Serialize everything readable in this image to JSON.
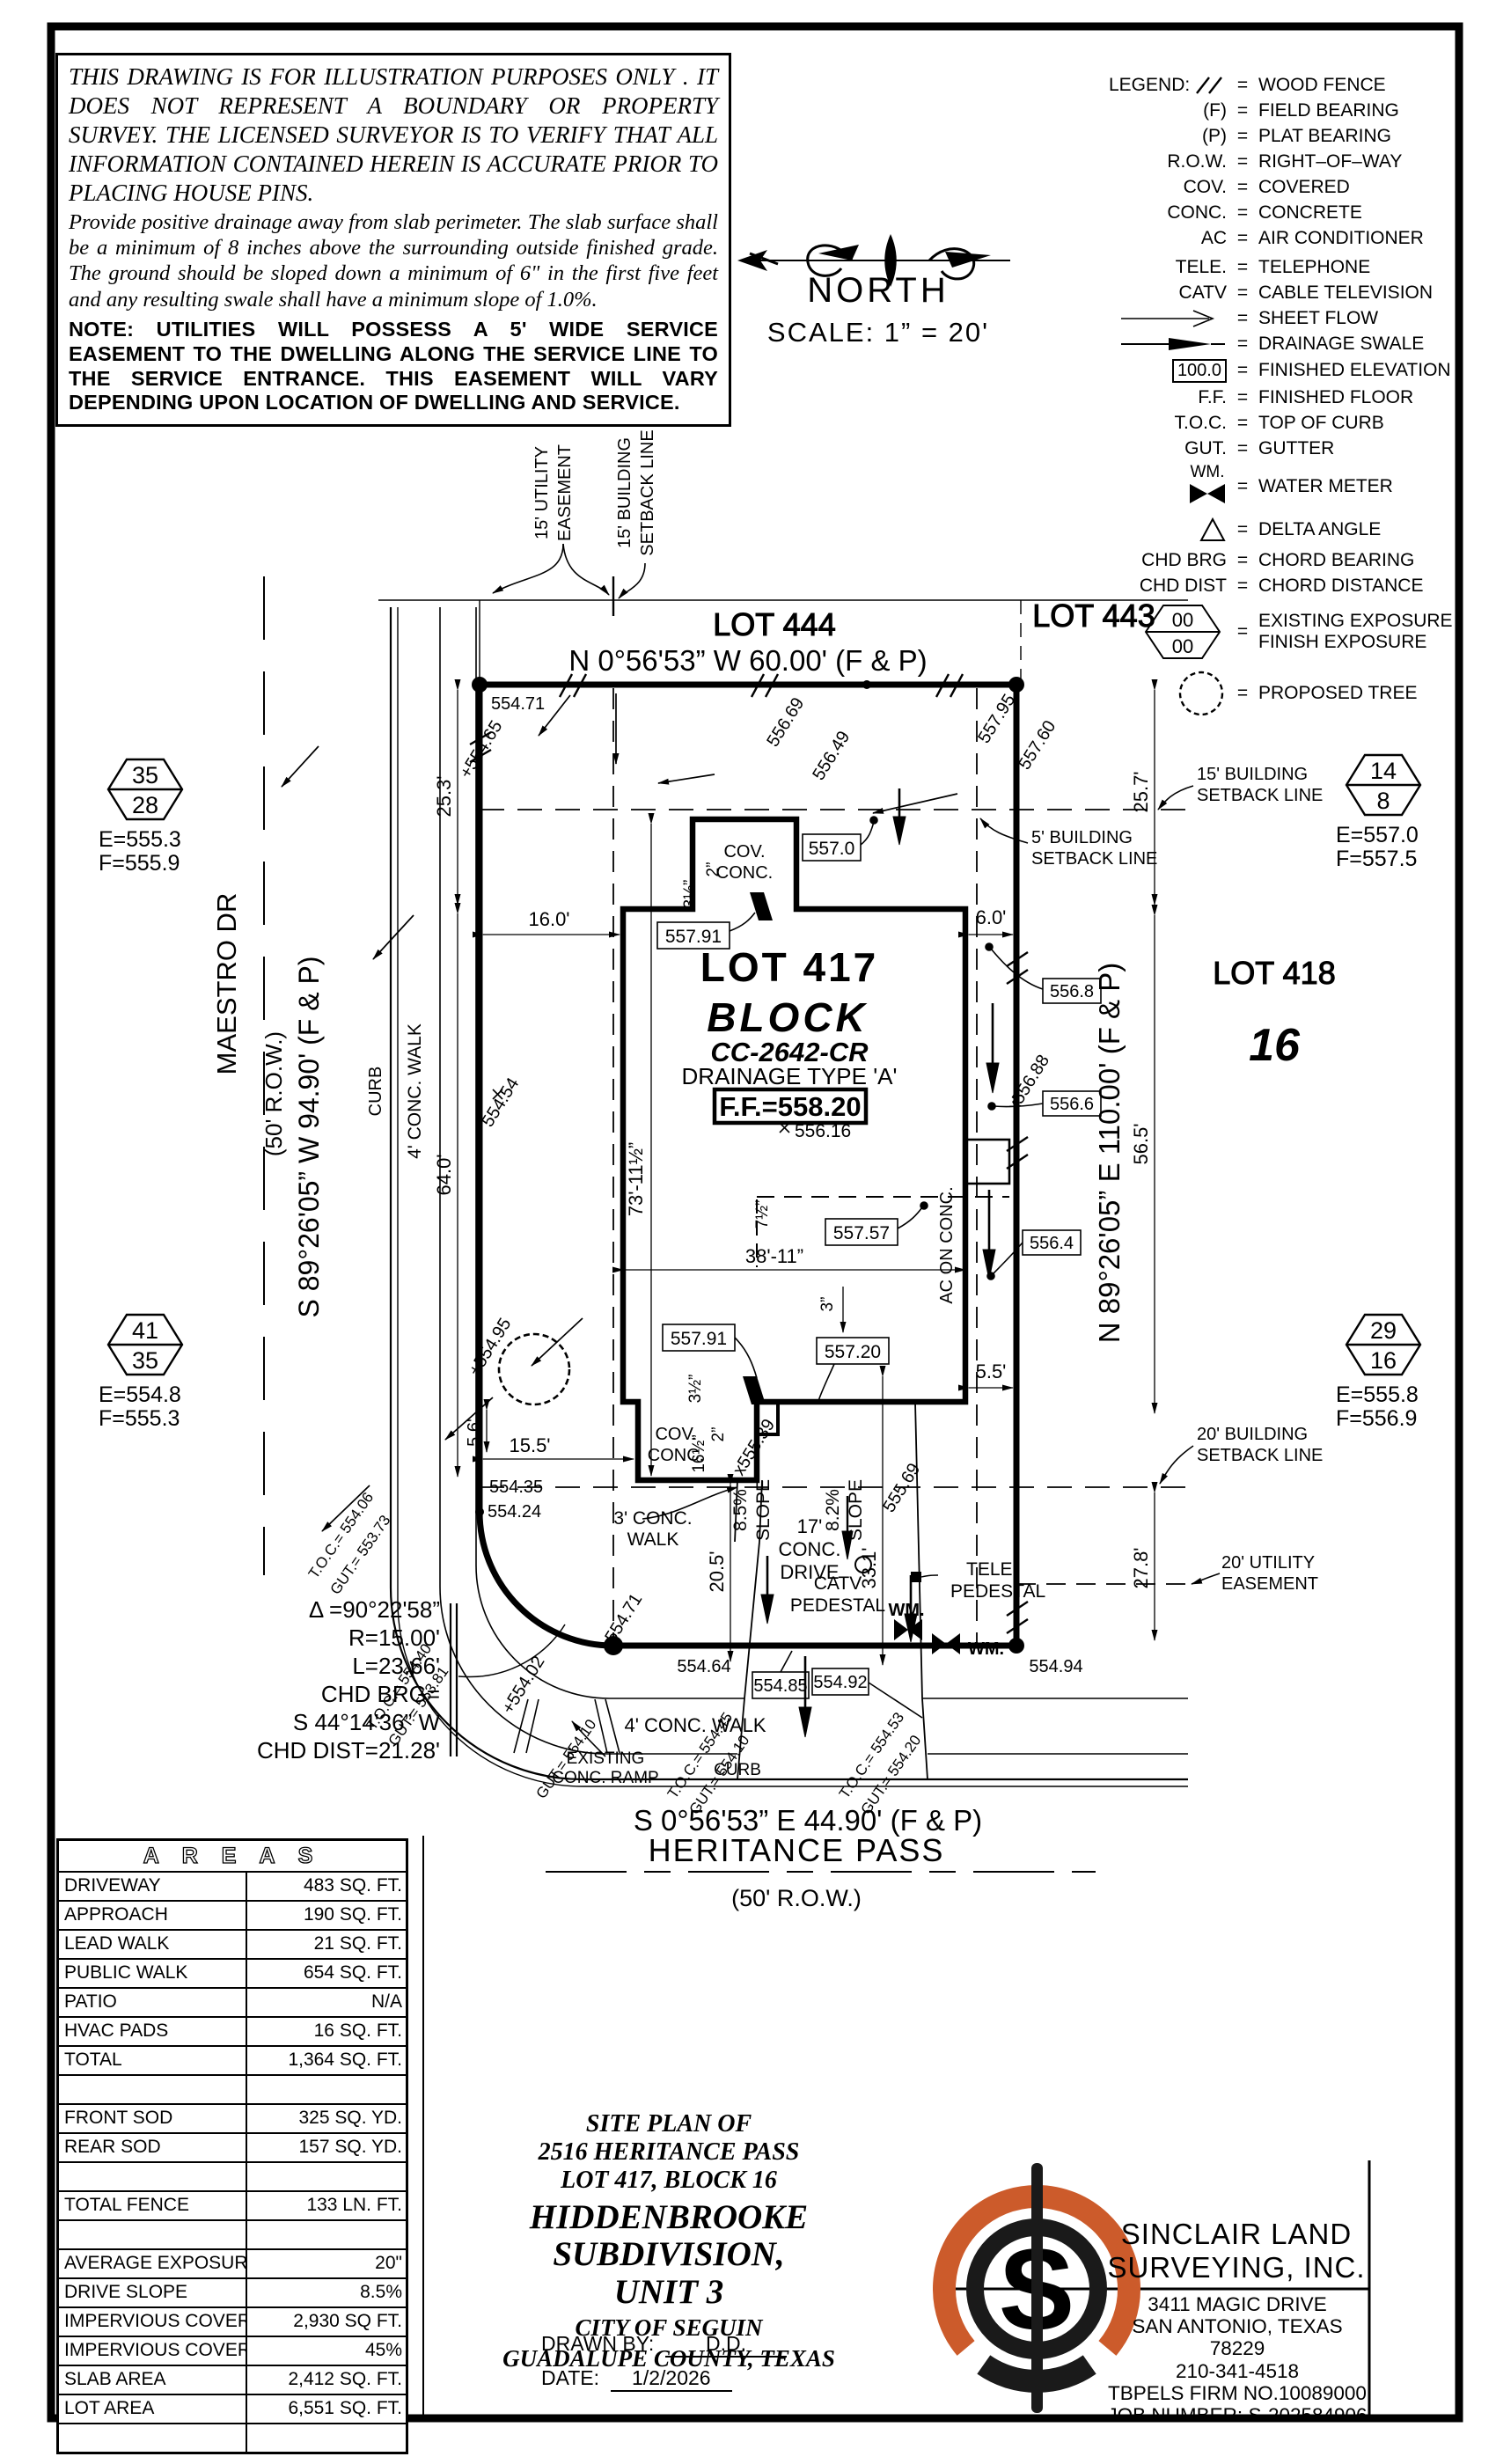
{
  "colors": {
    "paper": "#ffffff",
    "ink": "#000000",
    "accent": "#cc5b2b"
  },
  "disclaimer": {
    "para1": "THIS DRAWING IS FOR ILLUSTRATION PURPOSES ONLY . IT DOES NOT REPRESENT A BOUNDARY OR PROPERTY SURVEY. THE LICENSED SURVEYOR IS TO VERIFY THAT ALL INFORMATION CONTAINED HEREIN IS ACCURATE PRIOR TO PLACING HOUSE PINS.",
    "para2": "Provide positive drainage away from slab perimeter. The slab surface shall be a minimum of 8 inches above the surrounding outside finished grade. The ground should be sloped down a minimum of 6\" in the first five feet and any resulting swale shall have a minimum slope of 1.0%.",
    "note": "NOTE: UTILITIES WILL POSSESS A 5' WIDE SERVICE EASEMENT TO THE DWELLING ALONG THE SERVICE LINE TO THE SERVICE ENTRANCE. THIS EASEMENT WILL VARY DEPENDING UPON LOCATION OF DWELLING AND SERVICE."
  },
  "north": {
    "label": "NORTH",
    "scale": "SCALE:  1”  =  20'"
  },
  "legend": {
    "title": "LEGEND:",
    "items": [
      {
        "sym": "",
        "desc": "WOOD FENCE"
      },
      {
        "sym": "(F)",
        "desc": "FIELD BEARING"
      },
      {
        "sym": "(P)",
        "desc": "PLAT BEARING"
      },
      {
        "sym": "R.O.W.",
        "desc": "RIGHT–OF–WAY"
      },
      {
        "sym": "COV.",
        "desc": "COVERED"
      },
      {
        "sym": "CONC.",
        "desc": "CONCRETE"
      },
      {
        "sym": "AC",
        "desc": "AIR CONDITIONER"
      },
      {
        "sym": "TELE.",
        "desc": "TELEPHONE"
      },
      {
        "sym": "CATV",
        "desc": "CABLE TELEVISION"
      },
      {
        "sym": "",
        "desc": "SHEET FLOW"
      },
      {
        "sym": "",
        "desc": "DRAINAGE SWALE"
      },
      {
        "sym": "100.0",
        "desc": "FINISHED ELEVATION"
      },
      {
        "sym": "F.F.",
        "desc": "FINISHED FLOOR"
      },
      {
        "sym": "T.O.C.",
        "desc": "TOP OF CURB"
      },
      {
        "sym": "GUT.",
        "desc": "GUTTER"
      },
      {
        "sym": "WM.",
        "desc": "WATER METER"
      },
      {
        "sym": "",
        "desc": "DELTA ANGLE"
      },
      {
        "sym": "CHD BRG",
        "desc": "CHORD BEARING"
      },
      {
        "sym": "CHD DIST",
        "desc": "CHORD DISTANCE"
      },
      {
        "sym": "00",
        "sym2": "00",
        "desc": "EXISTING EXPOSURE",
        "desc2": "FINISH EXPOSURE"
      },
      {
        "sym": "",
        "desc": "PROPOSED TREE"
      }
    ]
  },
  "plot": {
    "labels": {
      "lot444": "LOT 444",
      "lot443": "LOT 443",
      "lot418": "LOT 418",
      "block16_num": "16",
      "brg_top": "N 0°56'53” W 60.00' (F & P)",
      "brg_bottom": "S 0°56'53” E 44.90' (F & P)",
      "brg_west": "S 89°26'05” W 94.90' (F & P)",
      "brg_east": "N 89°26'05” E 110.00' (F & P)",
      "maestro": "MAESTRO DR",
      "maestro_row": "(50' R.O.W.)",
      "heritance": "HERITANCE PASS",
      "heritance_row": "(50' R.O.W.)",
      "lot417": "LOT 417",
      "block_word": "BLOCK",
      "cc_number": "CC-2642-CR",
      "drainage": "DRAINAGE TYPE 'A'",
      "ff": "F.F.=558.20",
      "hex1a": "35",
      "hex1b": "28",
      "hex1e": "E=555.3",
      "hex1f": "F=555.9",
      "hex2a": "14",
      "hex2b": "8",
      "hex2e": "E=557.0",
      "hex2f": "F=557.5",
      "hex3a": "41",
      "hex3b": "35",
      "hex3e": "E=554.8",
      "hex3f": "F=555.3",
      "hex4a": "29",
      "hex4b": "16",
      "hex4e": "E=555.8",
      "hex4f": "F=556.9",
      "ue15a": "15' UTILITY",
      "ue15b": "EASEMENT",
      "bsl15a": "15' BUILDING",
      "bsl15b": "SETBACK LINE",
      "bsl15ra": "15' BUILDING",
      "bsl15rb": "SETBACK LINE",
      "bsl5a": "5' BUILDING",
      "bsl5b": "SETBACK LINE",
      "bsl20a": "20' BUILDING",
      "bsl20b": "SETBACK LINE",
      "ue20a": "20' UTILITY",
      "ue20b": "EASEMENT",
      "covt1": "COV.",
      "covt2": "CONC.",
      "covb1": "COV.",
      "covb2": "CONC.",
      "walk4_left": "4' CONC. WALK",
      "curb_left": "CURB",
      "walk4_bottom": "4' CONC. WALK",
      "curb_bottom": "CURB",
      "walk3a": "3' CONC.",
      "walk3b": "WALK",
      "drive17a": "17'",
      "drive17b": "CONC.",
      "drive17c": "DRIVE",
      "slope85a": "8.5%",
      "slope85b": "SLOPE",
      "slope82a": "8.2%",
      "slope82b": "SLOPE",
      "catva": "CATV",
      "catvb": "PEDESTAL",
      "telea": "TELE.",
      "teleb": "PEDESTAL",
      "wm1": "WM.",
      "wm2": "WM.",
      "ac_conc": "AC ON CONC.",
      "rampa": "EXISTING",
      "rampb": "CONC. RAMP",
      "d253": "25.3'",
      "d257": "25.7'",
      "d160": "16.0'",
      "d60": "6.0'",
      "d640": "64.0'",
      "d565": "56.5'",
      "d278": "27.8'",
      "d73": "73'-11½”",
      "d38": "38'-11”",
      "d205": "20.5'",
      "d331": "33.1'",
      "d155": "15.5'",
      "d56": "5.6'",
      "d55": "5.5'",
      "i2a": "2”",
      "i35a": "3½”",
      "i2b": "2”",
      "i35b": "3½”",
      "i165": "16½”",
      "i75": "7½”",
      "i3": "3”",
      "e5570": "557.0",
      "e55791a": "557.91",
      "e55791b": "557.91",
      "e55757": "557.57",
      "e55720": "557.20",
      "e5568": "556.8",
      "e5566": "556.6",
      "e5564": "556.4",
      "e55485": "554.85",
      "e55492": "554.92",
      "s55471a": "554.71",
      "s55465": "+554.65",
      "s55454": "554.54",
      "s55495": "+554.95",
      "s55435": "554.35",
      "s55424": "554.24",
      "s55402": "+554.02",
      "s55471b": "554.71",
      "s55464": "554.64",
      "s55494": "554.94",
      "s55795": "557.95",
      "s55760": "557.60",
      "s55669": "556.69",
      "s55649": "556.49",
      "s55539": "x555.39",
      "s55569": "555.69",
      "s55688": "x556.88",
      "s55616": "556.16",
      "toc1": "T.O.C.= 554.06",
      "gut1": "GUT.= 553.73",
      "toc2": "T.O.C.= 554.40",
      "gut2": "GUT.= 553.81",
      "gut3": "GUT.= 554.10",
      "toc4": "T.O.C.= 554.45",
      "gut4": "GUT.= 554.10",
      "toc5": "T.O.C.= 554.53",
      "gut5": "GUT.= 554.20",
      "cv1": "Δ =90°22'58”",
      "cv2": "R=15.00'",
      "cv3": "L=23.66'",
      "cv4": "CHD BRG=",
      "cv5": "S 44°14'36” W",
      "cv6": "CHD DIST=21.28'"
    }
  },
  "areas_table": {
    "title": "A R E A S",
    "rows": [
      {
        "label": "DRIVEWAY",
        "value": "483 SQ. FT."
      },
      {
        "label": "APPROACH",
        "value": "190 SQ. FT."
      },
      {
        "label": "LEAD WALK",
        "value": "21 SQ. FT."
      },
      {
        "label": "PUBLIC WALK",
        "value": "654 SQ. FT."
      },
      {
        "label": "PATIO",
        "value": "N/A"
      },
      {
        "label": "HVAC PADS",
        "value": "16 SQ. FT."
      },
      {
        "label": "TOTAL",
        "value": "1,364 SQ. FT."
      },
      {
        "label": "",
        "value": ""
      },
      {
        "label": "FRONT SOD",
        "value": "325 SQ. YD."
      },
      {
        "label": "REAR SOD",
        "value": "157 SQ. YD."
      },
      {
        "label": "",
        "value": ""
      },
      {
        "label": "TOTAL FENCE",
        "value": "133 LN. FT."
      },
      {
        "label": "",
        "value": ""
      },
      {
        "label": "AVERAGE EXPOSURE",
        "value": "20\""
      },
      {
        "label": "DRIVE SLOPE",
        "value": "8.5%"
      },
      {
        "label": "IMPERVIOUS COVERAGE",
        "value": "2,930 SQ FT."
      },
      {
        "label": "IMPERVIOUS COVERAGE %",
        "value": "45%"
      },
      {
        "label": "SLAB AREA",
        "value": "2,412 SQ. FT."
      },
      {
        "label": "LOT AREA",
        "value": "6,551 SQ. FT."
      },
      {
        "label": "",
        "value": ""
      }
    ]
  },
  "title_block": {
    "l1": "SITE PLAN OF",
    "l2": "2516 HERITANCE PASS",
    "l3": "LOT 417, BLOCK 16",
    "l4": "HIDDENBROOKE SUBDIVISION,",
    "l5": "UNIT 3",
    "l6": "CITY OF SEGUIN",
    "l7": "GUADALUPE COUNTY, TEXAS",
    "drawn_by_label": "DRAWN BY:",
    "drawn_by": "D.D.",
    "date_label": "DATE:",
    "date": "1/2/2026"
  },
  "company": {
    "name1": "SINCLAIR LAND",
    "name2": "SURVEYING, INC.",
    "addr1": "3411 MAGIC DRIVE",
    "addr2": "SAN ANTONIO, TEXAS 78229",
    "phone": "210-341-4518",
    "firm": "TBPELS FIRM NO.10089000",
    "job": "JOB NUMBER: S-202584906",
    "logo_letter": "S"
  }
}
